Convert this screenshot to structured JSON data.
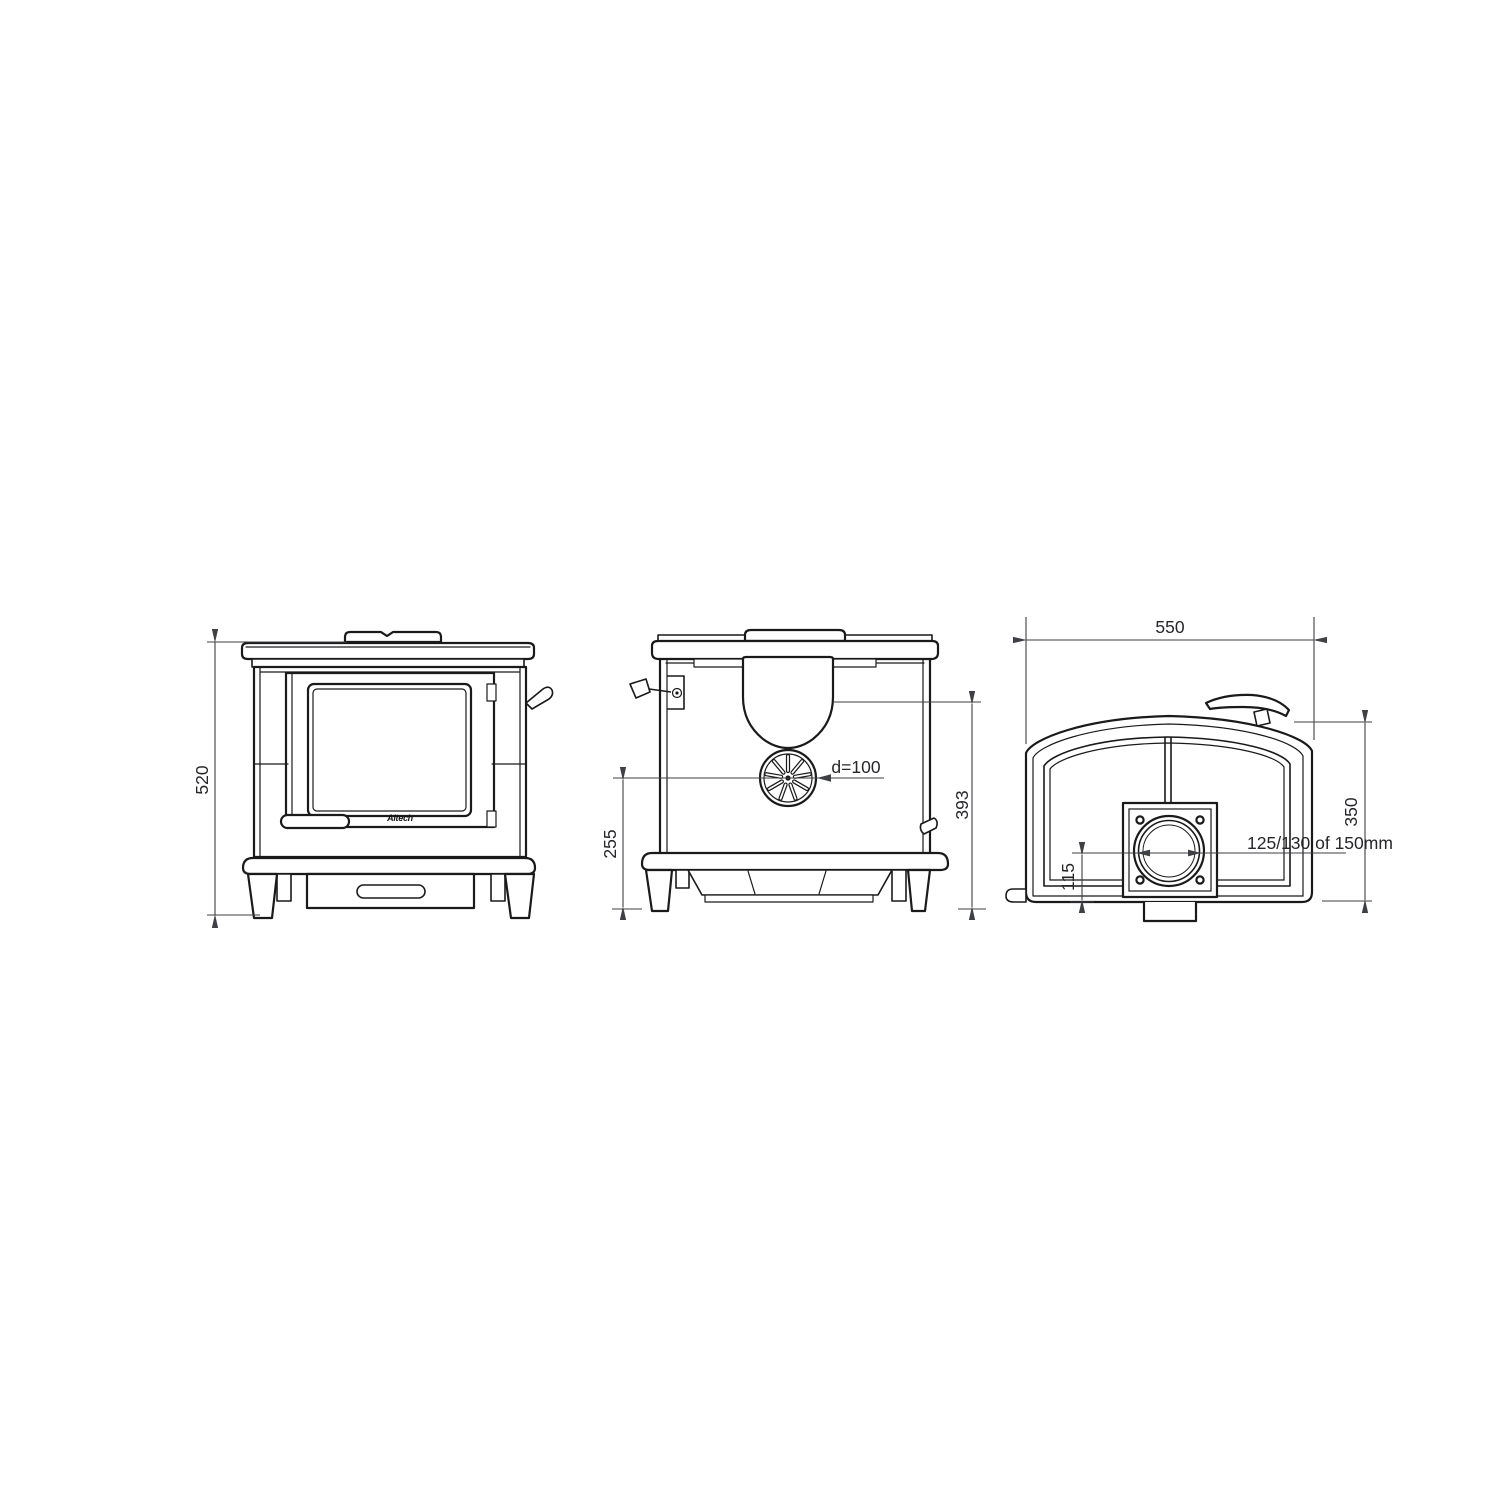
{
  "drawing": {
    "type": "technical-drawing",
    "subject": "wood stove, three orthographic views with dimensions (mm)",
    "colors": {
      "background": "#ffffff",
      "part_lines": "#1a1a1a",
      "dimension_lines": "#3f3f46",
      "dimension_text": "#26262b"
    },
    "front_view": {
      "dim_height": "520",
      "logo": "Altech"
    },
    "side_view": {
      "dim_fan_center_height": "255",
      "dim_fan_diameter": "d=100",
      "dim_rear_height": "393"
    },
    "rear_view": {
      "dim_width": "550",
      "dim_height": "350",
      "dim_flue_center_height": "115",
      "flue_note": "125/130 of 150mm"
    }
  }
}
